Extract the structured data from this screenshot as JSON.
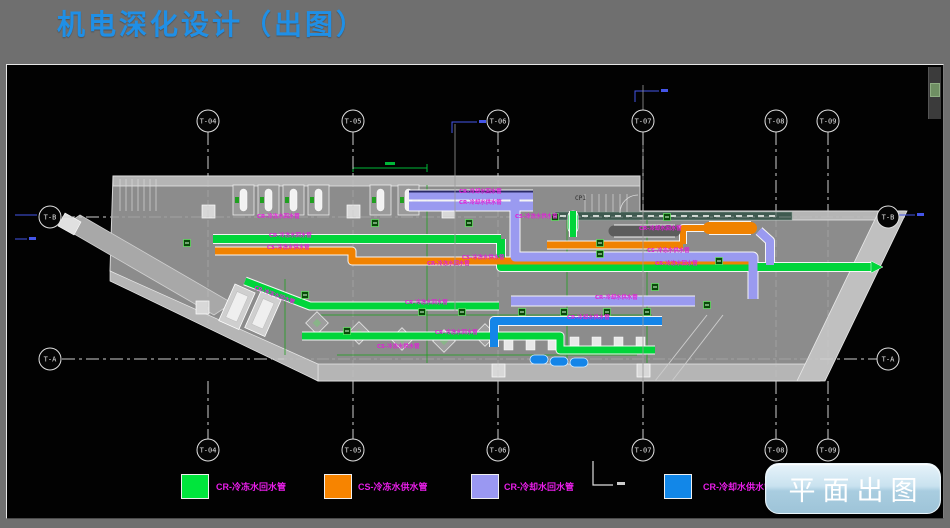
{
  "header": {
    "title": "机电深化设计（出图）"
  },
  "legend": {
    "items": [
      {
        "color": "#00e53c",
        "label": "CR-冷冻水回水管",
        "x": 174,
        "label_x": 209
      },
      {
        "color": "#f78400",
        "label": "CS-冷冻水供水管",
        "x": 317,
        "label_x": 351
      },
      {
        "color": "#9a98f2",
        "label": "CR-冷却水回水管",
        "x": 464,
        "label_x": 497
      },
      {
        "color": "#1287e8",
        "label": "CR-冷却水供水管",
        "x": 657,
        "label_x": 696
      },
      {
        "y": 409,
        "label_y": 415
      }
    ]
  },
  "action_button": {
    "label": "平面出图"
  },
  "drawing": {
    "palette": {
      "green": "#00d53a",
      "orange": "#f08200",
      "lav": "#9a9af0",
      "blue": "#1485e8",
      "dark": "#5c5c5c",
      "dim": "#1f9f1f",
      "magenta": "#e020d8",
      "wall": "#b5b5b5",
      "floor": "#8c8c8c",
      "line": "#d6d6d6",
      "bluemark": "#4455e8",
      "greendim": "#00b838"
    },
    "grid": {
      "circle_r": 11,
      "columns": [
        {
          "label": "T-04",
          "x": 201,
          "top_cy": 56,
          "bot_cy": 385,
          "t1": 67,
          "t2": 111,
          "b1": 316,
          "b2": 374
        },
        {
          "label": "T-05",
          "x": 346,
          "top_cy": 56,
          "bot_cy": 385,
          "t1": 67,
          "t2": 111,
          "b1": 316,
          "b2": 374
        },
        {
          "label": "T-06",
          "x": 491,
          "top_cy": 56,
          "bot_cy": 385,
          "t1": 67,
          "t2": 111,
          "b1": 316,
          "b2": 374
        },
        {
          "label": "T-07",
          "x": 636,
          "top_cy": 56,
          "bot_cy": 385,
          "t1": 67,
          "t2": 146,
          "b1": 316,
          "b2": 374
        },
        {
          "label": "T-08",
          "x": 769,
          "top_cy": 56,
          "bot_cy": 385,
          "t1": 67,
          "t2": 146,
          "b1": 316,
          "b2": 374
        },
        {
          "label": "T-09",
          "x": 821,
          "top_cy": 56,
          "bot_cy": 385,
          "t1": 67,
          "t2": 146,
          "b1": 316,
          "b2": 374
        }
      ],
      "rows": [
        {
          "label": "T-B",
          "y": 152,
          "left_cx": 43,
          "right_cx": 881,
          "l1": 55,
          "l2": 104,
          "r1": 870,
          "r2": 898
        },
        {
          "label": "T-A",
          "y": 294,
          "left_cx": 43,
          "right_cx": 881,
          "l1": 55,
          "l2": 277,
          "r1": 813,
          "r2": 870
        }
      ]
    },
    "building": {
      "outline": [
        [
          106,
          111
        ],
        [
          633,
          111
        ],
        [
          633,
          146
        ],
        [
          898,
          146
        ],
        [
          813,
          316
        ],
        [
          311,
          316
        ],
        [
          103,
          206
        ]
      ],
      "top_wall": [
        [
          106,
          111
        ],
        [
          633,
          111
        ],
        [
          633,
          121
        ],
        [
          106,
          121
        ]
      ],
      "top_wall_right": [
        [
          633,
          146
        ],
        [
          898,
          146
        ],
        [
          894,
          155
        ],
        [
          633,
          155
        ]
      ],
      "bottom_wall": [
        [
          311,
          299
        ],
        [
          813,
          299
        ],
        [
          813,
          316
        ],
        [
          311,
          316
        ]
      ],
      "left_diag_wall": [
        [
          103,
          206
        ],
        [
          311,
          299
        ],
        [
          311,
          316
        ],
        [
          103,
          216
        ]
      ],
      "ramp": [
        [
          790,
          316
        ],
        [
          818,
          316
        ],
        [
          900,
          146
        ],
        [
          872,
          146
        ]
      ],
      "wing": [
        [
          55,
          162
        ],
        [
          73,
          150
        ],
        [
          225,
          238
        ],
        [
          207,
          250
        ]
      ],
      "wing_cap": [
        [
          58,
          148
        ],
        [
          74,
          157
        ],
        [
          67,
          170
        ],
        [
          51,
          161
        ]
      ],
      "teal_band": {
        "x": 548,
        "y": 147,
        "w": 237,
        "h": 8,
        "fill": "#3f5a50"
      },
      "section_line_x": 633,
      "braces": [
        [
          [
            648,
            316
          ],
          [
            700,
            250
          ]
        ],
        [
          [
            665,
            316
          ],
          [
            716,
            250
          ]
        ]
      ],
      "stairs_left": {
        "x": 113,
        "y1": 114,
        "y2": 146,
        "n": 7,
        "step": 6
      },
      "stairs_mid": {
        "x": 578,
        "y1": 129,
        "y2": 147,
        "n": 7,
        "step": 7
      },
      "door_arc": "M613,148 A18,18 0 0 1 631,130",
      "columns_sq": [
        [
          195,
          140
        ],
        [
          340,
          140
        ],
        [
          435,
          140
        ],
        [
          485,
          299
        ],
        [
          630,
          299
        ],
        [
          189,
          236
        ]
      ]
    },
    "pipes": [
      {
        "c": "green",
        "w": 8,
        "p": [
          [
            206,
            174
          ],
          [
            494,
            174
          ]
        ]
      },
      {
        "c": "green",
        "w": 8,
        "p": [
          [
            494,
            174
          ],
          [
            494,
            202
          ],
          [
            864,
            202
          ]
        ]
      },
      {
        "c": "green",
        "w": 7,
        "p": [
          [
            238,
            216
          ],
          [
            303,
            241
          ],
          [
            492,
            241
          ]
        ]
      },
      {
        "c": "green",
        "w": 7,
        "p": [
          [
            295,
            271
          ],
          [
            553,
            271
          ],
          [
            553,
            285
          ],
          [
            648,
            285
          ]
        ]
      },
      {
        "c": "green",
        "w": 6,
        "p": [
          [
            566,
            146
          ],
          [
            566,
            172
          ]
        ]
      },
      {
        "c": "orange",
        "w": 7,
        "p": [
          [
            208,
            186
          ],
          [
            345,
            186
          ],
          [
            345,
            196
          ],
          [
            744,
            196
          ]
        ]
      },
      {
        "c": "orange",
        "w": 7,
        "p": [
          [
            540,
            180
          ],
          [
            676,
            180
          ]
        ]
      },
      {
        "c": "orange",
        "w": 6,
        "p": [
          [
            676,
            179
          ],
          [
            676,
            163
          ],
          [
            698,
            163
          ]
        ]
      },
      {
        "c": "orange",
        "w": 12,
        "p": [
          [
            702,
            163
          ],
          [
            744,
            163
          ]
        ]
      },
      {
        "c": "lav",
        "w": 9,
        "p": [
          [
            402,
            130
          ],
          [
            526,
            130
          ]
        ]
      },
      {
        "c": "lav",
        "w": 9,
        "p": [
          [
            402,
            141
          ],
          [
            526,
            141
          ]
        ]
      },
      {
        "c": "lav",
        "w": 9,
        "p": [
          [
            508,
            134
          ],
          [
            508,
            192
          ],
          [
            746,
            192
          ],
          [
            746,
            234
          ]
        ]
      },
      {
        "c": "lav",
        "w": 9,
        "p": [
          [
            504,
            236
          ],
          [
            688,
            236
          ]
        ]
      },
      {
        "c": "lav",
        "w": 8,
        "p": [
          [
            752,
            166
          ],
          [
            763,
            176
          ],
          [
            763,
            200
          ]
        ]
      },
      {
        "c": "blue",
        "w": 8,
        "p": [
          [
            487,
            282
          ],
          [
            487,
            256
          ],
          [
            655,
            256
          ]
        ]
      },
      {
        "c": "dark",
        "w": 11,
        "p": [
          [
            607,
            166
          ],
          [
            668,
            166
          ]
        ]
      }
    ],
    "thin_lines": [
      [
        [
          420,
          120
        ],
        [
          420,
          298
        ]
      ],
      [
        [
          560,
          155
        ],
        [
          560,
          298
        ]
      ],
      [
        [
          640,
          155
        ],
        [
          640,
          298
        ]
      ],
      [
        [
          310,
          250
        ],
        [
          645,
          250
        ]
      ],
      [
        [
          330,
          290
        ],
        [
          630,
          290
        ]
      ],
      [
        [
          278,
          214
        ],
        [
          278,
          290
        ]
      ]
    ],
    "pipe_labels": [
      {
        "x": 262,
        "y": 172,
        "t": "CR-冷冻水回水管"
      },
      {
        "x": 420,
        "y": 200,
        "t": "CR-冷冻水回水管"
      },
      {
        "x": 648,
        "y": 200,
        "t": "CR-冷冻水回水管"
      },
      {
        "x": 250,
        "y": 153,
        "t": "CR-冷冻水回水管"
      },
      {
        "x": 260,
        "y": 184,
        "t": "CS-冷冻水供水管"
      },
      {
        "x": 455,
        "y": 194,
        "t": "CS-冷冻水供水管"
      },
      {
        "x": 640,
        "y": 187,
        "t": "CS-冷冻水供水管"
      },
      {
        "x": 508,
        "y": 153,
        "t": "CS-冷冻水供水管"
      },
      {
        "x": 452,
        "y": 128,
        "t": "CR-冷却水回水管"
      },
      {
        "x": 452,
        "y": 139,
        "t": "CR-冷却水供水管"
      },
      {
        "x": 632,
        "y": 165,
        "t": "CR-冷却水回水管"
      },
      {
        "x": 588,
        "y": 234,
        "t": "CR-冷却水供水管"
      },
      {
        "x": 560,
        "y": 254,
        "t": "CR-冷却水供水管"
      },
      {
        "x": 398,
        "y": 239,
        "t": "CR-冷冻水回水管"
      },
      {
        "x": 428,
        "y": 269,
        "t": "CR-冷冻水回水管"
      },
      {
        "x": 370,
        "y": 283,
        "t": "CS-冷冻水供水管"
      },
      {
        "x": 247,
        "y": 224,
        "t": "CR-冷冻水回水管",
        "a": 20
      }
    ],
    "room_label": {
      "x": 568,
      "y": 135,
      "t": "CP1"
    },
    "equipment": {
      "bays": {
        "xs": [
          226,
          251,
          276,
          301,
          363,
          391
        ],
        "y": 120,
        "w": 21,
        "h": 30
      },
      "fans": [
        [
          310,
          258
        ],
        [
          352,
          268
        ],
        [
          395,
          274
        ],
        [
          437,
          276
        ],
        [
          478,
          270
        ]
      ],
      "fan_size": 16,
      "chillers": [
        {
          "x": 228,
          "y": 219,
          "a": 24
        },
        {
          "x": 254,
          "y": 226,
          "a": 24
        }
      ],
      "chiller_w": 22,
      "chiller_h": 40,
      "blue_caps": [
        [
          523,
          290
        ],
        [
          543,
          292
        ],
        [
          563,
          293
        ]
      ],
      "fittings_y": 272,
      "fittings_xs": [
        497,
        519,
        541,
        563,
        585,
        607,
        629
      ],
      "green_pump": {
        "x": 561,
        "y": 146,
        "w": 10,
        "h": 22
      },
      "valves": [
        [
          548,
          152
        ],
        [
          660,
          152
        ],
        [
          593,
          178
        ],
        [
          593,
          189
        ],
        [
          415,
          247
        ],
        [
          455,
          247
        ],
        [
          515,
          247
        ],
        [
          557,
          247
        ],
        [
          600,
          247
        ],
        [
          640,
          247
        ],
        [
          340,
          266
        ],
        [
          298,
          230
        ],
        [
          712,
          196
        ],
        [
          462,
          158
        ],
        [
          648,
          222
        ],
        [
          700,
          240
        ],
        [
          180,
          178
        ],
        [
          368,
          158
        ]
      ]
    },
    "annotations": {
      "green_dim": {
        "x1": 346,
        "x2": 420,
        "y": 103
      },
      "blue_marks": [
        [
          [
            445,
            68
          ],
          [
            445,
            57
          ],
          [
            470,
            57
          ]
        ],
        [
          [
            628,
            37
          ],
          [
            628,
            26
          ],
          [
            652,
            26
          ]
        ],
        [
          [
            8,
            150
          ],
          [
            30,
            150
          ]
        ],
        [
          [
            885,
            150
          ],
          [
            908,
            150
          ]
        ],
        [
          [
            8,
            174
          ],
          [
            20,
            174
          ]
        ]
      ],
      "white_l": [
        [
          586,
          396
        ],
        [
          586,
          420
        ],
        [
          606,
          420
        ]
      ],
      "solid_vlines": [
        {
          "x": 636,
          "y1": 20,
          "y2": 316
        },
        {
          "x": 448,
          "y1": 59,
          "y2": 246
        }
      ]
    }
  }
}
